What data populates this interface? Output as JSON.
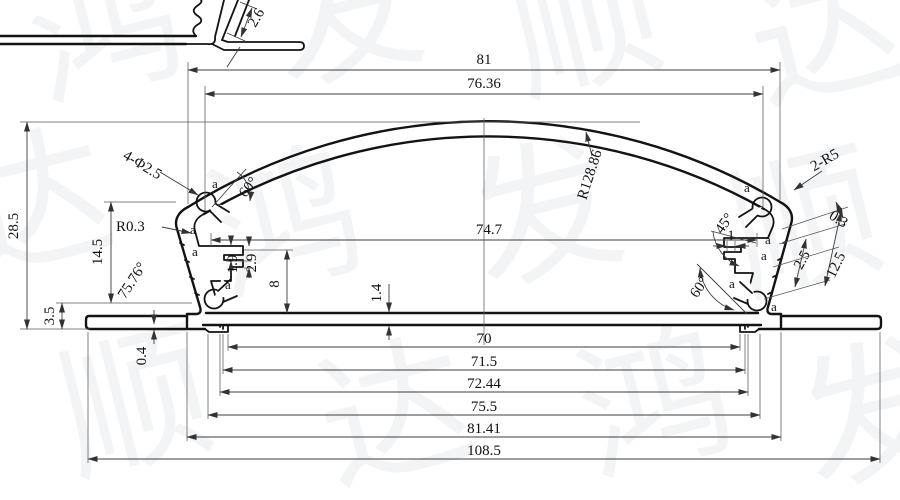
{
  "watermark": {
    "chars": [
      "鸿",
      "发",
      "顺",
      "达"
    ]
  },
  "detail_view": {
    "thickness": "2.6"
  },
  "dims": {
    "top_width": "81",
    "top_inner_width": "76.36",
    "overall_height": "28.5",
    "side_height": "14.5",
    "flange_height": "3.5",
    "base_lip": "0.4",
    "holes_label": "4-Φ2.5",
    "corner_fillet": "R0.3",
    "wall_angle": "75.76°",
    "left_slot_angle": "60°",
    "arc_radius": "R128.86",
    "top_corner_radius": "2-R5",
    "right_step_angle": "45°",
    "right_gap": "1",
    "wall_offset": "0.3",
    "wall_thickness": "2.5",
    "wall_length": "12.5",
    "right_slot_angle": "60°",
    "inner_width": "74.7",
    "step_1_9": "1.9",
    "step_2_9": "2.9",
    "step_height": "8",
    "base_thickness": "1.4",
    "channel_width": "70",
    "channel_step1": "71.5",
    "channel_step2": "72.44",
    "feet_inner_width": "75.5",
    "feet_outer_width": "81.41",
    "overall_width": "108.5",
    "point_label": "a"
  }
}
